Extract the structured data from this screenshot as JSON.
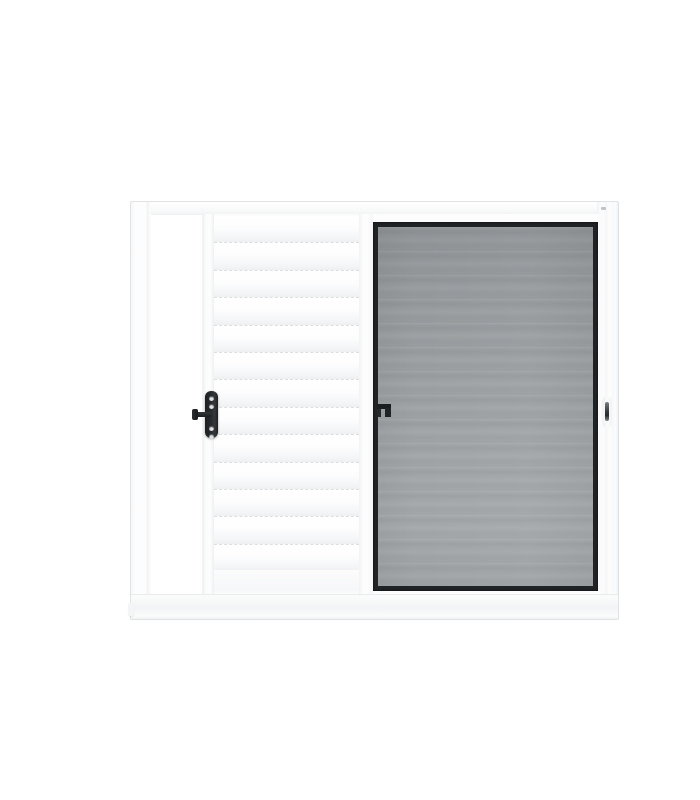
{
  "scene": {
    "type": "product-photo",
    "subject": "white aluminum sliding window, three sections: open track gap, white louver shutter panel with black latch, smoked glass sash with black frame",
    "background_color": "#ffffff"
  },
  "window": {
    "sections": [
      {
        "name": "open-track-gap"
      },
      {
        "name": "louver-shutter-panel"
      },
      {
        "name": "glass-sash-panel"
      }
    ]
  },
  "louver": {
    "slat_count": 13
  },
  "hardware": {
    "shutter_latch": {
      "name": "black-latch-plate-with-handle-arm",
      "hole_count": 4
    },
    "glass_latch": {
      "name": "black-hook-latch"
    },
    "frame_catch": {
      "name": "recessed-metal-catch"
    }
  },
  "colors": {
    "background": "#ffffff",
    "frame_white": "#fdfdfd",
    "frame_outline": "#e1e2e3",
    "frame_line": "#eef0f1",
    "louver_face": "#fbfbfc",
    "louver_line": "#dcdfe2",
    "glass_frame_black": "#202326",
    "glass_top": "#8e9295",
    "glass_mid": "#9b9fa2",
    "glass_bottom": "#9da1a4",
    "hardware_black": "#26292c",
    "hardware_metal": "#54585b"
  }
}
